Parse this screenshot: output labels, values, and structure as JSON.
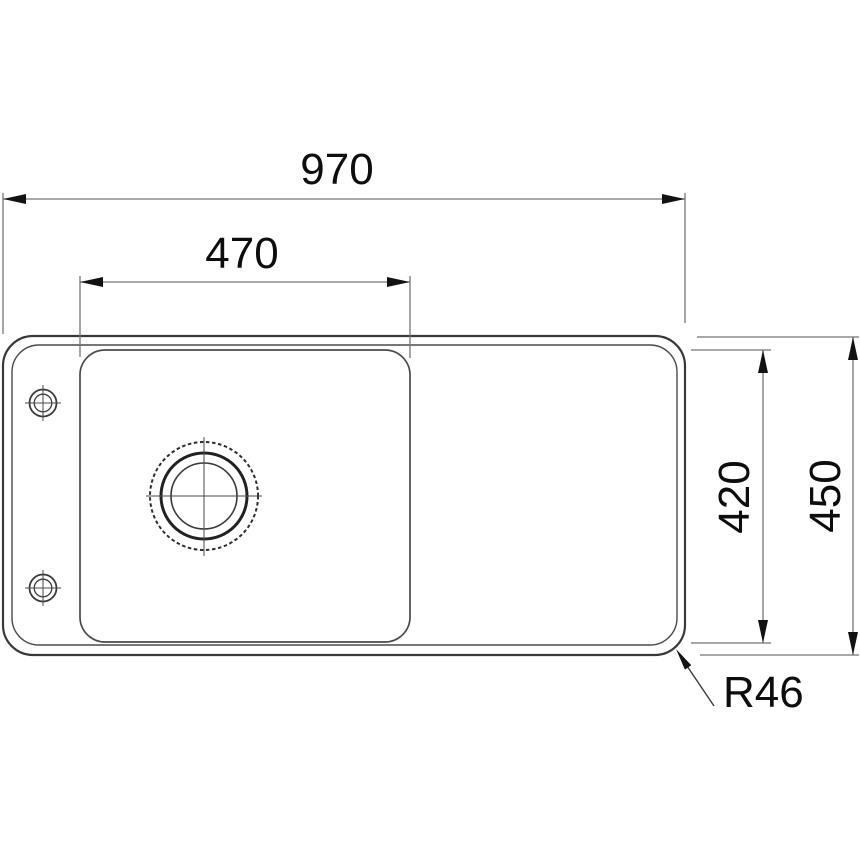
{
  "drawing": {
    "title": "sink-top-view-technical-drawing",
    "labels": {
      "overall_width": "970",
      "bowl_width": "470",
      "inner_depth": "420",
      "overall_depth": "450",
      "corner_radius": "R46"
    },
    "colors": {
      "background": "#ffffff",
      "outline": "#3a3a3a",
      "secondary_outline": "#5a5a5a",
      "dimension_line": "#757575",
      "arrow": "#121212",
      "text": "#0d0d0d"
    }
  }
}
